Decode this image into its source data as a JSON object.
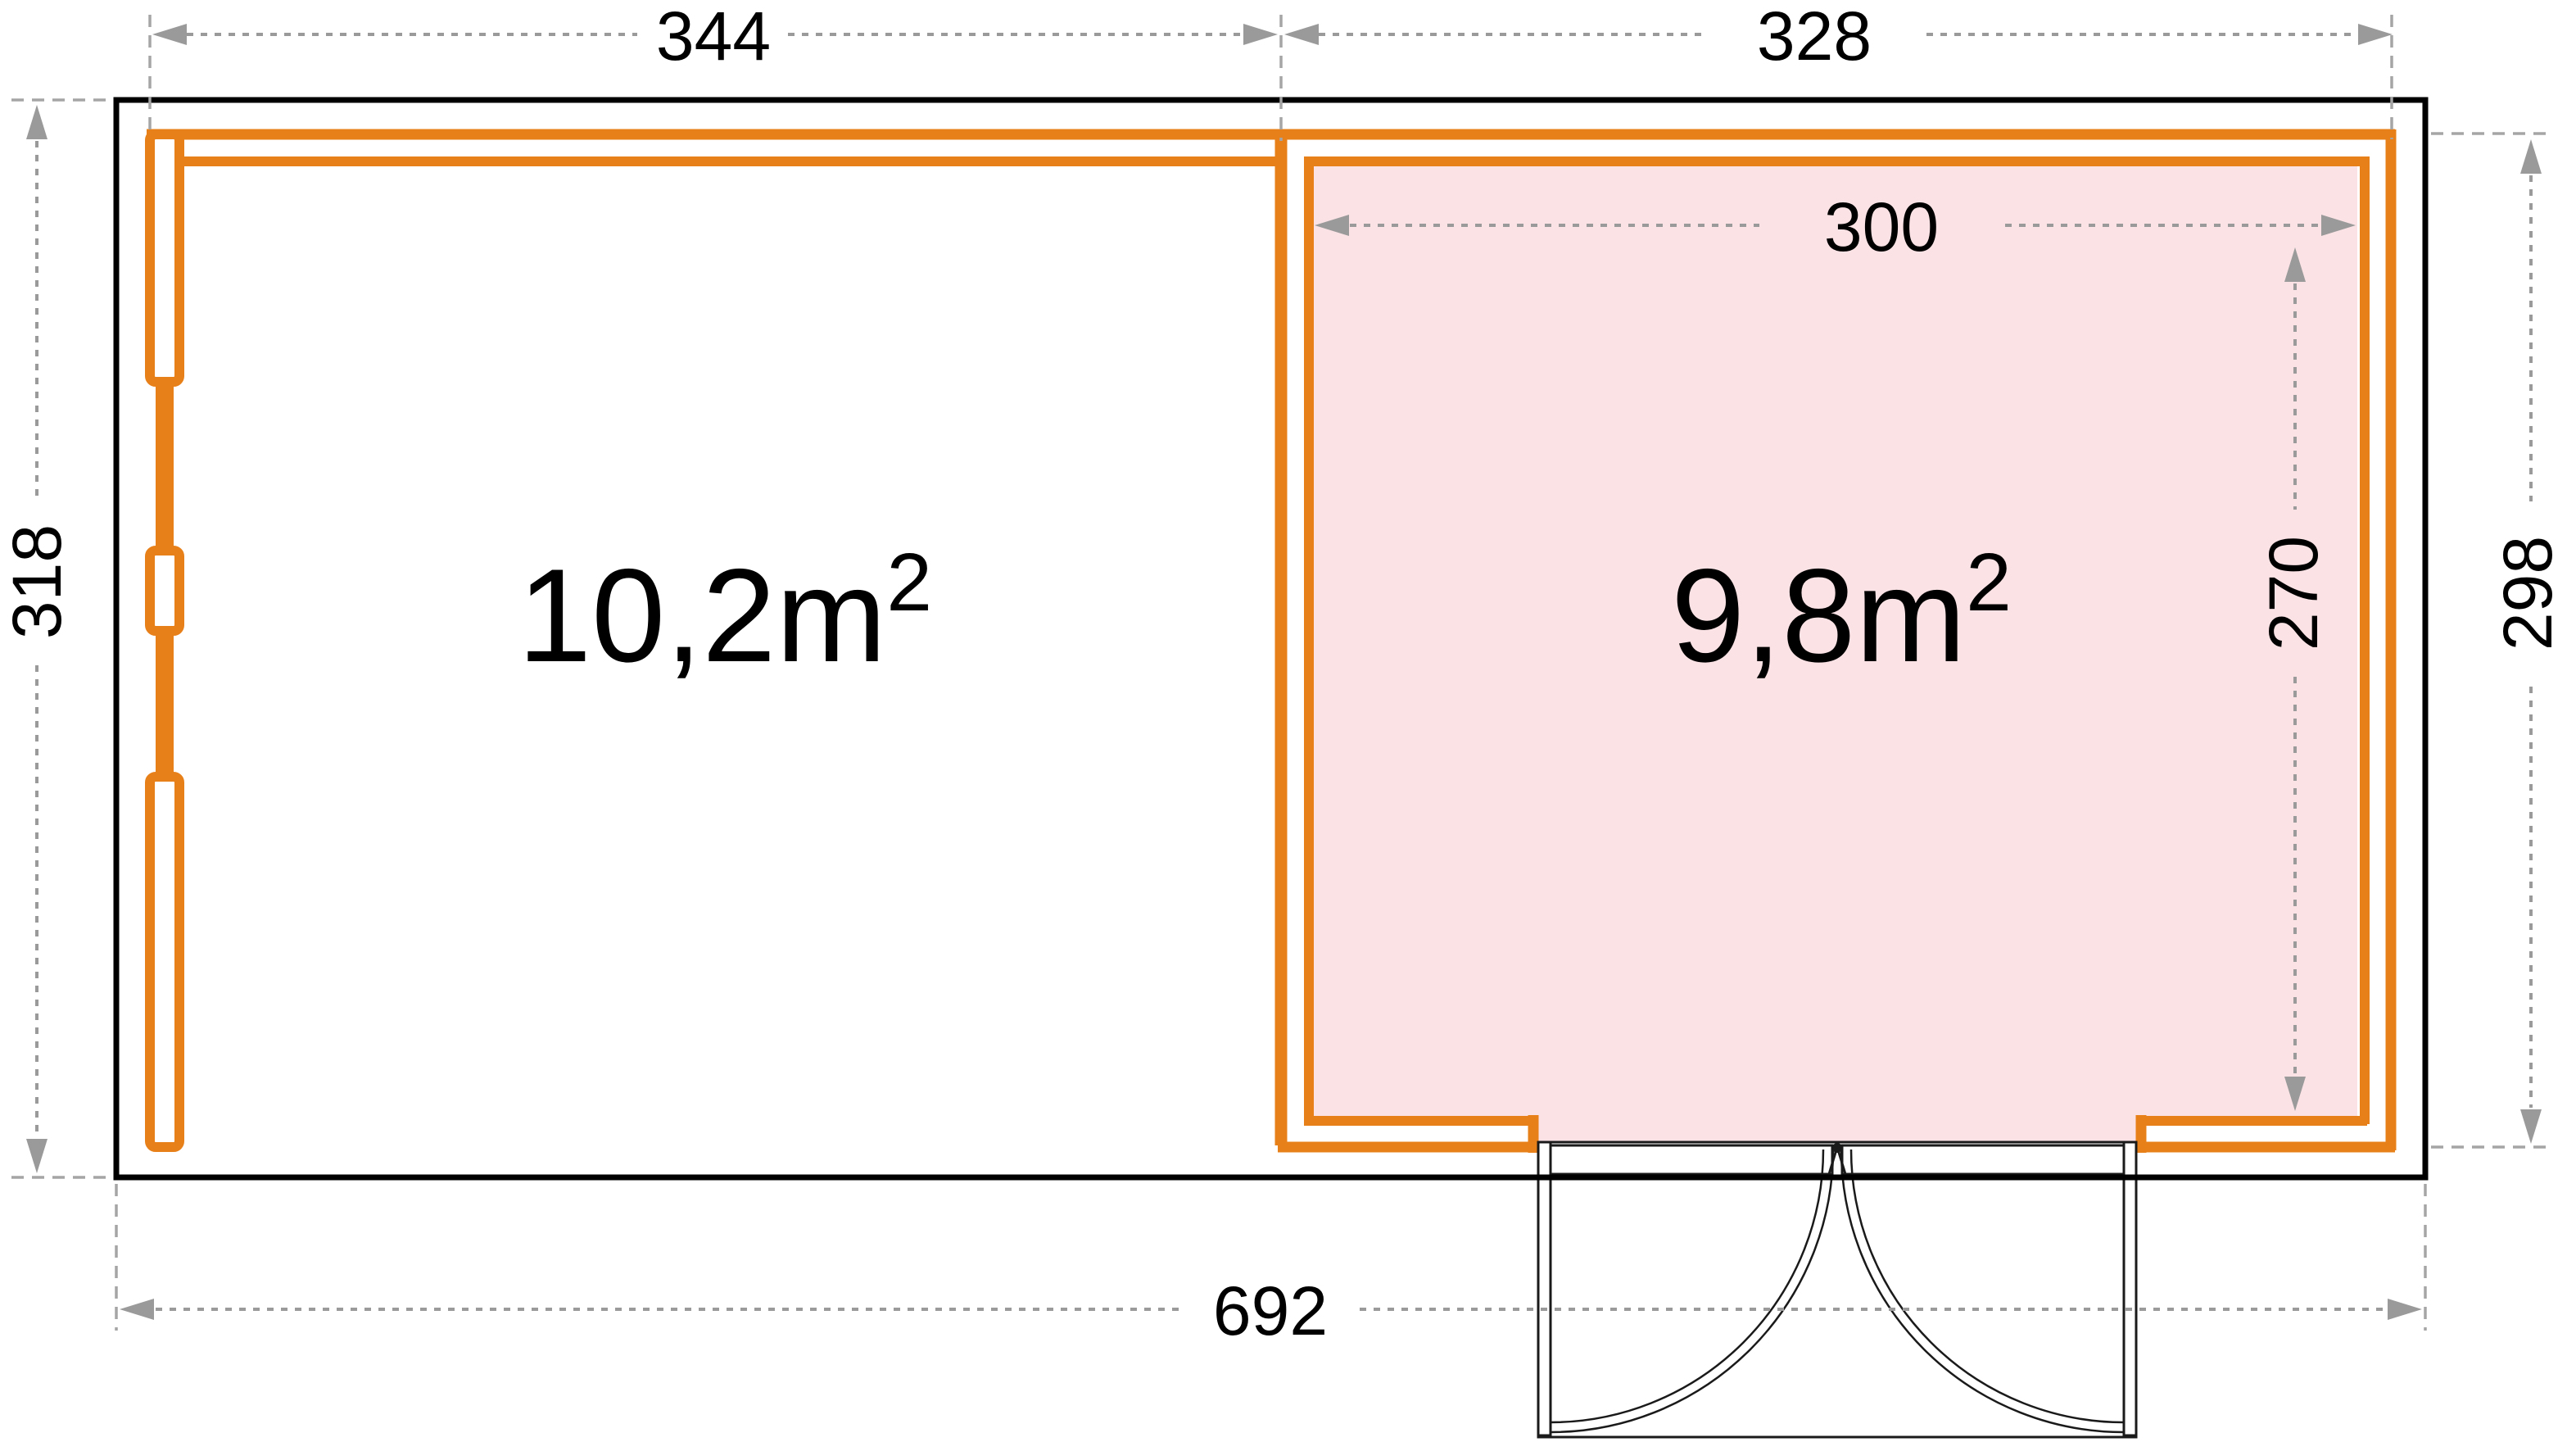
{
  "plan": {
    "type": "floor-plan",
    "dimensions": {
      "top_left_width": "344",
      "top_right_width": "328",
      "left_height": "318",
      "right_height": "298",
      "inner_room_width": "300",
      "inner_room_height": "270",
      "total_width": "692"
    },
    "rooms": {
      "left": {
        "area": "10,2m",
        "area_exponent": "2"
      },
      "right": {
        "area": "9,8m",
        "area_exponent": "2"
      }
    }
  },
  "colors": {
    "wall_orange": "#E8801A",
    "room_pink": "#FAE2E5",
    "outline_black": "#000000",
    "dim_gray": "#9A9A9A",
    "connector_gray": "#A5A5A5",
    "door_line": "#1A1A1A"
  }
}
